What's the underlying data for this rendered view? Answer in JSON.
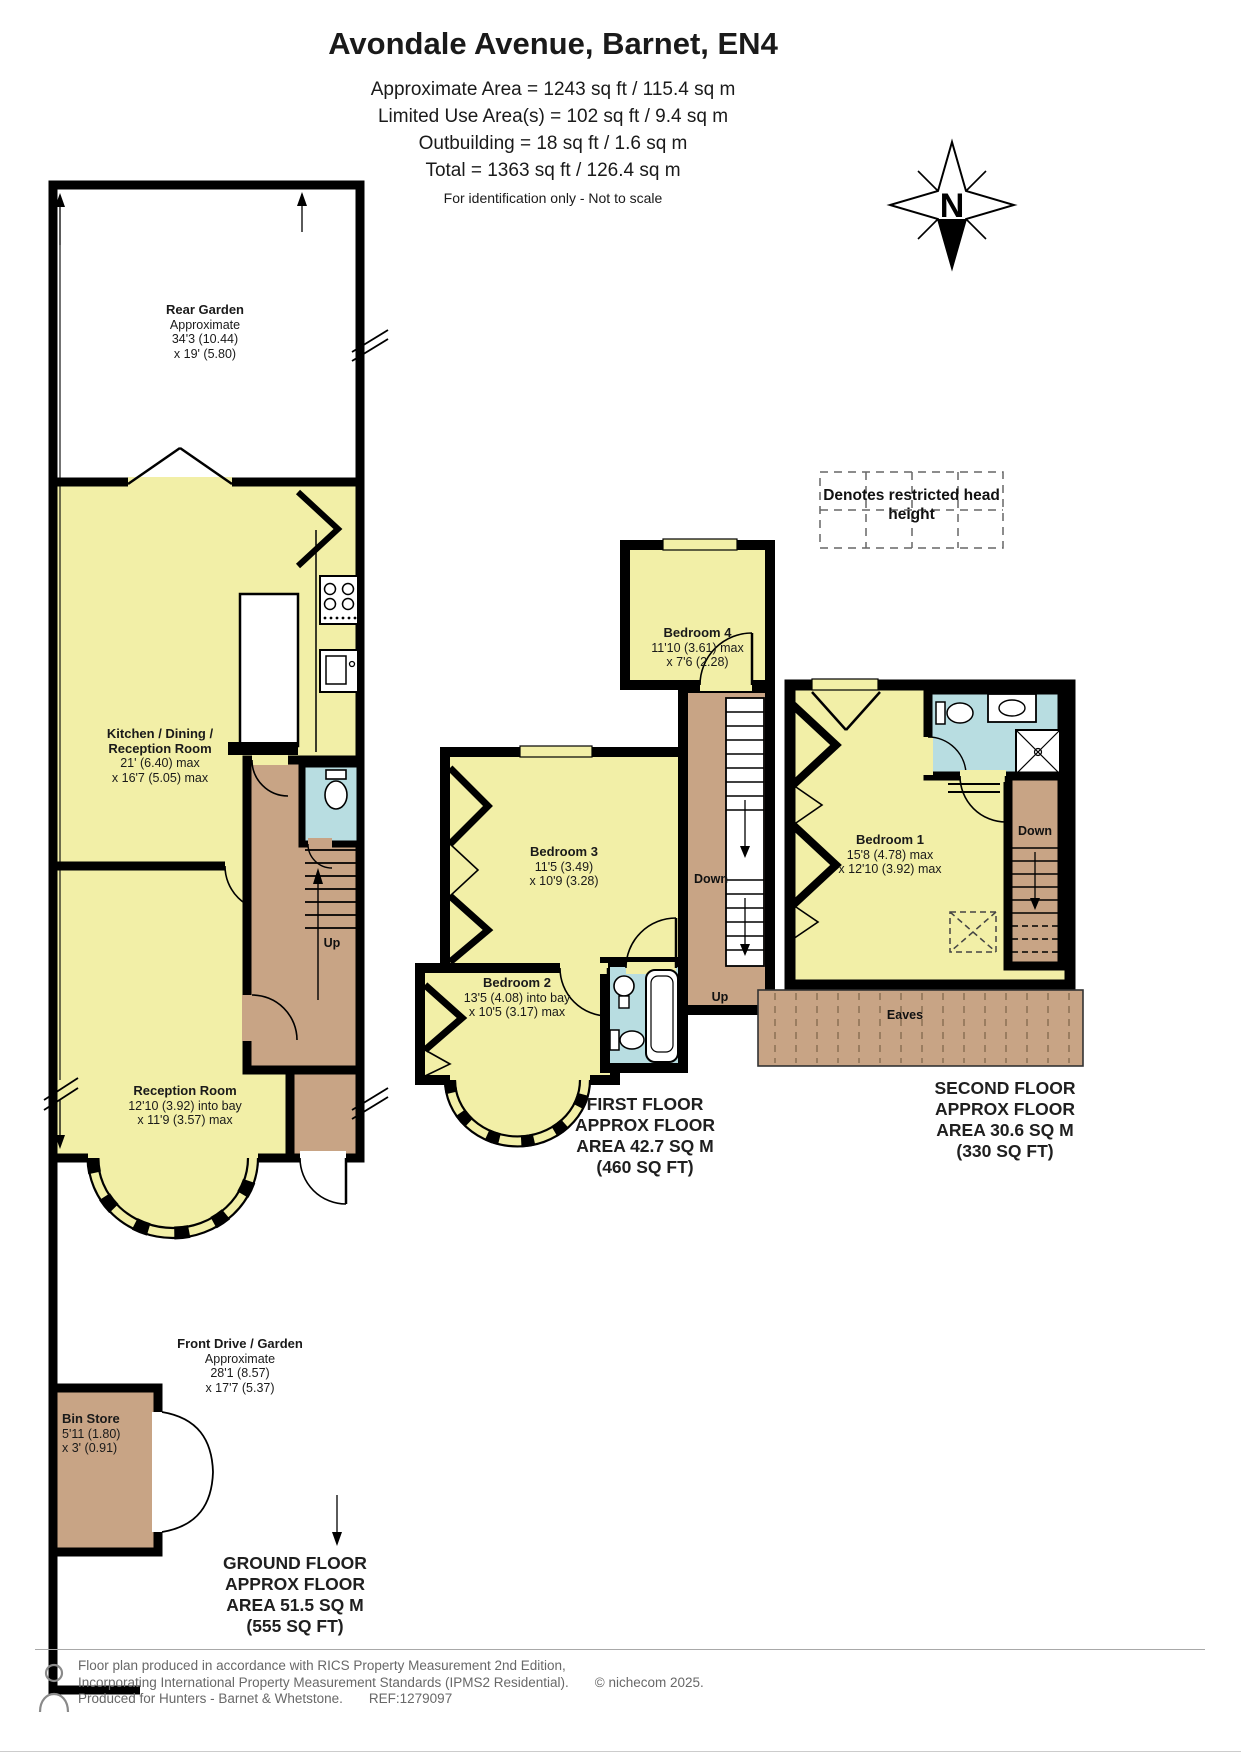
{
  "header": {
    "title": "Avondale Avenue, Barnet, EN4",
    "area_lines": [
      "Approximate Area = 1243 sq ft / 115.4 sq m",
      "Limited Use Area(s) = 102 sq ft / 9.4 sq m",
      "Outbuilding = 18 sq ft / 1.6 sq m",
      "Total = 1363 sq ft / 126.4 sq m"
    ],
    "disclaimer": "For identification only - Not to scale"
  },
  "compass": {
    "north_label": "N"
  },
  "legend": {
    "text": "Denotes restricted head height"
  },
  "ground_floor": {
    "rear_garden": {
      "title": "Rear Garden",
      "lines": [
        "Approximate",
        "34'3 (10.44)",
        "x 19' (5.80)"
      ]
    },
    "kitchen": {
      "title_lines": [
        "Kitchen / Dining /",
        "Reception Room"
      ],
      "lines": [
        "21' (6.40) max",
        "x 16'7 (5.05) max"
      ]
    },
    "reception": {
      "title": "Reception Room",
      "lines": [
        "12'10 (3.92) into bay",
        "x 11'9 (3.57) max"
      ]
    },
    "front_drive": {
      "title": "Front Drive / Garden",
      "lines": [
        "Approximate",
        "28'1 (8.57)",
        "x 17'7 (5.37)"
      ]
    },
    "bin_store": {
      "title": "Bin Store",
      "lines": [
        "5'11 (1.80)",
        "x 3' (0.91)"
      ]
    },
    "stairs_up": "Up",
    "caption_lines": [
      "GROUND FLOOR",
      "APPROX FLOOR",
      "AREA 51.5 SQ M",
      "(555 SQ FT)"
    ]
  },
  "first_floor": {
    "bedroom_4": {
      "title": "Bedroom 4",
      "lines": [
        "11'10 (3.61) max",
        "x 7'6 (2.28)"
      ]
    },
    "bedroom_3": {
      "title": "Bedroom 3",
      "lines": [
        "11'5 (3.49)",
        "x 10'9 (3.28)"
      ]
    },
    "bedroom_2": {
      "title": "Bedroom 2",
      "lines": [
        "13'5 (4.08) into bay",
        "x 10'5 (3.17) max"
      ]
    },
    "stairs_down": "Down",
    "stairs_up": "Up",
    "caption_lines": [
      "FIRST FLOOR",
      "APPROX FLOOR",
      "AREA 42.7 SQ M",
      "(460 SQ FT)"
    ]
  },
  "second_floor": {
    "bedroom_1": {
      "title": "Bedroom 1",
      "lines": [
        "15'8 (4.78) max",
        "x 12'10 (3.92) max"
      ]
    },
    "stairs_down": "Down",
    "eaves": "Eaves",
    "caption_lines": [
      "SECOND FLOOR",
      "APPROX FLOOR",
      "AREA 30.6 SQ M",
      "(330 SQ FT)"
    ]
  },
  "footer": {
    "line1": "Floor plan produced in accordance with RICS Property Measurement 2nd Edition,",
    "line2": "Incorporating International Property Measurement Standards (IPMS2 Residential).",
    "copyright": "© nichecom 2025.",
    "line3": "Produced for Hunters - Barnet & Whetstone.",
    "ref": "REF:1279097"
  },
  "colors": {
    "room_yellow": "#F2EFA7",
    "hall_tan": "#C8A485",
    "bath_blue": "#B8DDE1",
    "wall_black": "#000000"
  }
}
